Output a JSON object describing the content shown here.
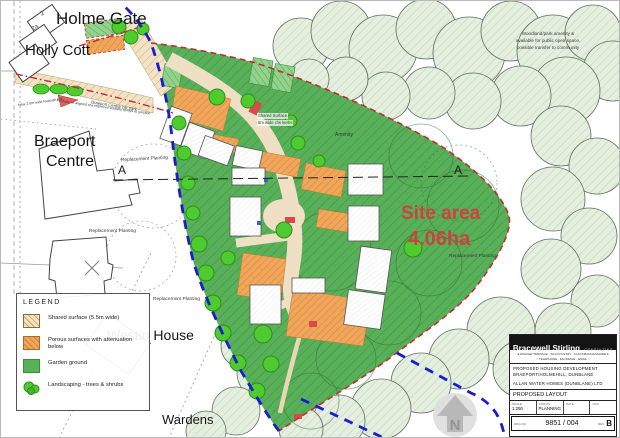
{
  "plan": {
    "labels": {
      "holme_gate": "Holme Gate",
      "holly_cott": "Holly Cott",
      "braeport_line1": "Braeport",
      "braeport_line2": "Centre",
      "westin_house": "Westin House",
      "wardens": "Wardens",
      "site_area_line1": "Site area",
      "site_area_line2": "4.06ha",
      "section_marker": "A",
      "amenity": "Amenity",
      "replacement_planting": "Replacement Planting",
      "shared_surface_note_line1": "Shared Surface",
      "shared_surface_note_line2": "5m wide c/w kerbs",
      "woodland_note_line1": "Woodland/park amenity &",
      "woodland_note_line2": "available for public open space,",
      "woodland_note_line3": "possible transfer to community",
      "access_note_upper": "New 2.0m wide footpath link",
      "access_note_lower": "Footway re-aligned c/w improved visibility splays at junction",
      "car_park_note": "Braeport Centre car park",
      "plot_2": "2",
      "plot_2a": "2a",
      "north": "N"
    },
    "legend": {
      "title": "LEGEND",
      "items": [
        {
          "label": "Shared surface (5.5m wide)",
          "swatch": "shared-surface"
        },
        {
          "label": "Porous surfaces with attenuation below",
          "swatch": "porous-surface"
        },
        {
          "label": "Garden ground",
          "swatch": "garden-ground"
        },
        {
          "label": "Landscaping - trees & shrubs",
          "swatch": "landscaping-trees"
        }
      ]
    },
    "title_block": {
      "firm_name": "Bracewell Stirling",
      "firm_suffix": "CONSULTING",
      "office_line1": "WALKER TERRACE · TILLICOULTRY · CLACKMANNANSHIRE",
      "office_line2": "TELEPHONE · FACSIMILE · EMAIL",
      "project_line1": "PROPOSED HOUSING DEVELOPMENT",
      "project_line2": "BRAEPORT/HOLMEHILL, DUNBLANE",
      "project_line3": "ALLAN WATER HOMES (DUNBLANE) LTD",
      "drawing_title": "PROPOSED LAYOUT",
      "scale_label": "SCALE",
      "scale_value": "1:250",
      "status_label": "STATUS",
      "status_value": "PLANNING",
      "date_label": "DATE",
      "date_value": "",
      "checked_label": "CKD",
      "checked_value": "",
      "drg_label": "DRG NO",
      "drg_number": "9851 / 004",
      "rev_label": "REV",
      "rev_value": "B"
    },
    "colors": {
      "site_green": "#57b257",
      "woodland_green": "#e4efdf",
      "road_tan": "#efe0c5",
      "porous_orange": "#f0a75c",
      "boundary_blue": "#1b1bd0",
      "boundary_red": "#c22b35",
      "site_area_text": "#d04040"
    }
  }
}
